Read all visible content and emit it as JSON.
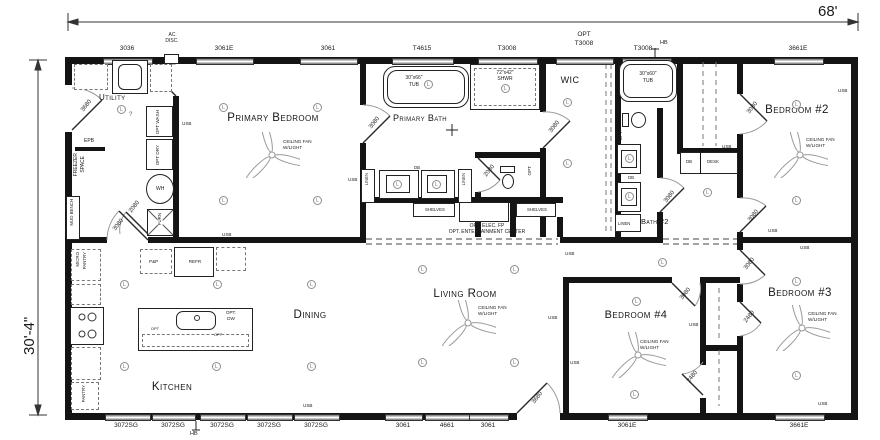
{
  "dimensions": {
    "width": "68'",
    "height": "30'-4\""
  },
  "rooms": {
    "utility": "Utility",
    "primary_bedroom": "Primary Bedroom",
    "primary_bath": "Primary Bath",
    "wic": "WIC",
    "bath2": "Bath #2",
    "bedroom2": "Bedroom #2",
    "bedroom3": "Bedroom #3",
    "bedroom4": "Bedroom #4",
    "kitchen": "Kitchen",
    "dining": "Dining",
    "living": "Living Room"
  },
  "windows": {
    "top": [
      "3036",
      "3061E",
      "3061",
      "T4615",
      "T3008",
      "T3008",
      "3661E"
    ],
    "opt_prefix": "OPT",
    "opt_window": "T3008",
    "bottom": [
      "3072SG",
      "3072SG",
      "3072SG",
      "3072SG",
      "3072SG",
      "3061",
      "4661",
      "3061",
      "3061E",
      "3661E"
    ]
  },
  "doors": {
    "entry": "3680",
    "living_exterior": "3680",
    "utility_kitchen": "3080",
    "furnace_closet": "2080",
    "primary_bath": "3080",
    "bath_wic": "3080",
    "water_closet": "2080",
    "bath2": "3080",
    "bedroom2_hall": "3080",
    "bedroom2_lower": "3080",
    "bedroom4": "3080",
    "bedroom3": "3080",
    "closet_b3": "2480",
    "closet_b4": "2480"
  },
  "fixtures": {
    "tub_primary_size": "30\"x66\"",
    "tub_primary": "TUB",
    "shower_size": "72\"x42\"",
    "shower": "SHWR",
    "tub2_size": "30\"x60\"",
    "tub2": "TUB",
    "washer": "OPT WASH",
    "dryer": "OPT DRY",
    "water_heater": "WH",
    "furnace": "FURN",
    "freezer1": "FREEZER",
    "freezer2": "SPACE",
    "mud_bench": "MUD BENCH",
    "epb": "EPB",
    "micro1": "MICRO",
    "micro2": "PANTRY",
    "pantry": "PANTRY",
    "pots_pans": "P&P",
    "refrigerator": "REFR",
    "dw1": "OPT.",
    "dw2": "DW",
    "desk": "DESK",
    "db": "DB",
    "linen": "LINEN",
    "shelves": "SHELVES",
    "ac1": "AC",
    "ac2": "DISC.",
    "opt": "OPT",
    "elec_fp": "OPT. ELEC. FP",
    "ent_center": "OPT. ENTERTAINMENT CENTER"
  },
  "annotations": {
    "usb": "USB",
    "hb": "HB",
    "light": "L",
    "unknown": "?",
    "fan_line1": "CEILING FAN",
    "fan_line2": "W/LIGHT"
  }
}
